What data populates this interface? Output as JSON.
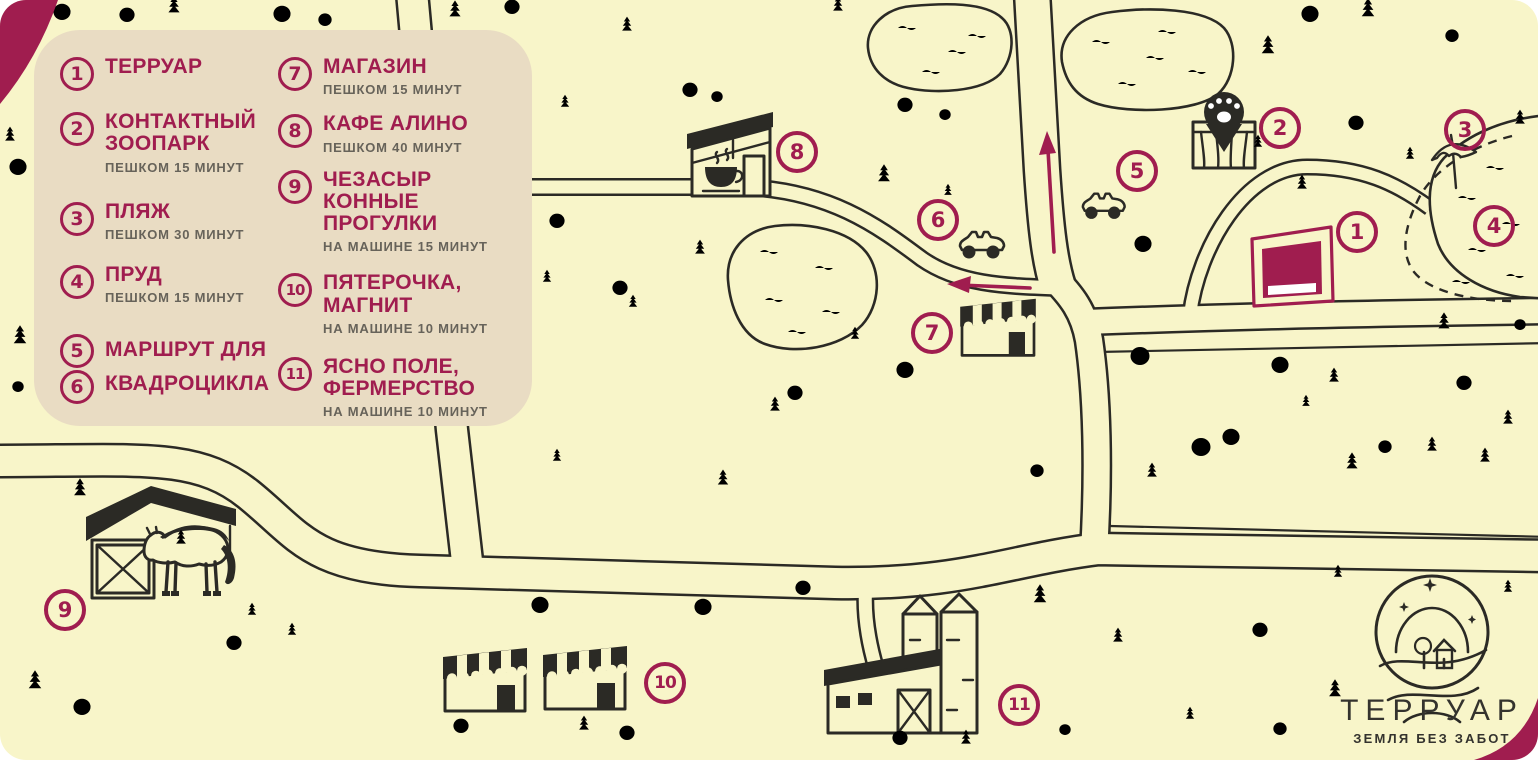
{
  "colors": {
    "background": "#F8F5C9",
    "legend_panel": "#E9DCC3",
    "accent": "#A01D4F",
    "ink": "#2B2A25",
    "note_text": "#67635A"
  },
  "logo": {
    "title": "ТЕРРУАР",
    "subtitle": "ЗЕМЛЯ БЕЗ ЗАБОТ"
  },
  "legend": {
    "columns": [
      [
        {
          "nums": [
            "1"
          ],
          "lines": [
            "ТЕРРУАР"
          ],
          "note": ""
        },
        {
          "nums": [
            "2"
          ],
          "lines": [
            "КОНТАКТНЫЙ",
            "ЗООПАРК"
          ],
          "note": "ПЕШКОМ 15 МИНУТ"
        },
        {
          "nums": [
            "3"
          ],
          "lines": [
            "ПЛЯЖ"
          ],
          "note": "ПЕШКОМ 30 МИНУТ"
        },
        {
          "nums": [
            "4"
          ],
          "lines": [
            "ПРУД"
          ],
          "note": "ПЕШКОМ 15 МИНУТ"
        },
        {
          "nums": [
            "5",
            "6"
          ],
          "lines": [
            "МАРШРУТ ДЛЯ",
            "КВАДРОЦИКЛА"
          ],
          "note": ""
        }
      ],
      [
        {
          "nums": [
            "7"
          ],
          "lines": [
            "МАГАЗИН"
          ],
          "note": "ПЕШКОМ 15 МИНУТ"
        },
        {
          "nums": [
            "8"
          ],
          "lines": [
            "КАФЕ АЛИНО"
          ],
          "note": "ПЕШКОМ 40 МИНУТ"
        },
        {
          "nums": [
            "9"
          ],
          "lines": [
            "ЧЕЗАСЫР",
            "КОННЫЕ ПРОГУЛКИ"
          ],
          "note": "НА МАШИНЕ 15 МИНУТ"
        },
        {
          "nums": [
            "10"
          ],
          "lines": [
            "ПЯТЕРОЧКА,",
            "МАГНИТ"
          ],
          "note": "НА МАШИНЕ 10 МИНУТ"
        },
        {
          "nums": [
            "11"
          ],
          "lines": [
            "ЯСНО ПОЛЕ,",
            "ФЕРМЕРСТВО"
          ],
          "note": "НА МАШИНЕ 10 МИНУТ"
        }
      ]
    ]
  },
  "markers": [
    {
      "label": "1",
      "x": 1357,
      "y": 232
    },
    {
      "label": "2",
      "x": 1280,
      "y": 128
    },
    {
      "label": "3",
      "x": 1465,
      "y": 130
    },
    {
      "label": "4",
      "x": 1494,
      "y": 226
    },
    {
      "label": "5",
      "x": 1137,
      "y": 171
    },
    {
      "label": "6",
      "x": 938,
      "y": 220
    },
    {
      "label": "7",
      "x": 932,
      "y": 333
    },
    {
      "label": "8",
      "x": 797,
      "y": 152
    },
    {
      "label": "9",
      "x": 65,
      "y": 610
    },
    {
      "label": "10",
      "x": 665,
      "y": 683
    },
    {
      "label": "11",
      "x": 1019,
      "y": 705
    }
  ],
  "decorations": [
    [
      "pine",
      174,
      14,
      0.8
    ],
    [
      "pine",
      455,
      18,
      0.8
    ],
    [
      "pine",
      627,
      32,
      0.7
    ],
    [
      "pine",
      838,
      12,
      0.7
    ],
    [
      "pine",
      565,
      108,
      0.6
    ],
    [
      "pine",
      884,
      183,
      0.85
    ],
    [
      "pine",
      948,
      196,
      0.55
    ],
    [
      "pine",
      700,
      255,
      0.7
    ],
    [
      "pine",
      547,
      283,
      0.6
    ],
    [
      "pine",
      633,
      308,
      0.6
    ],
    [
      "pine",
      855,
      340,
      0.6
    ],
    [
      "pine",
      775,
      412,
      0.7
    ],
    [
      "pine",
      723,
      486,
      0.75
    ],
    [
      "pine",
      557,
      462,
      0.6
    ],
    [
      "pine",
      1268,
      55,
      0.9
    ],
    [
      "pine",
      1368,
      18,
      0.9
    ],
    [
      "pine",
      1410,
      160,
      0.6
    ],
    [
      "pine",
      1520,
      125,
      0.7
    ],
    [
      "pine",
      1258,
      148,
      0.6
    ],
    [
      "pine",
      1302,
      190,
      0.7
    ],
    [
      "pine",
      1444,
      330,
      0.8
    ],
    [
      "pine",
      1508,
      425,
      0.7
    ],
    [
      "pine",
      1432,
      452,
      0.7
    ],
    [
      "pine",
      1334,
      383,
      0.7
    ],
    [
      "pine",
      1306,
      407,
      0.55
    ],
    [
      "pine",
      1352,
      470,
      0.8
    ],
    [
      "pine",
      1152,
      478,
      0.7
    ],
    [
      "pine",
      1485,
      463,
      0.7
    ],
    [
      "pine",
      10,
      142,
      0.7
    ],
    [
      "pine",
      20,
      345,
      0.9
    ],
    [
      "pine",
      80,
      497,
      0.85
    ],
    [
      "pine",
      181,
      545,
      0.7
    ],
    [
      "pine",
      252,
      616,
      0.6
    ],
    [
      "pine",
      35,
      690,
      0.9
    ],
    [
      "pine",
      292,
      636,
      0.6
    ],
    [
      "pine",
      584,
      731,
      0.7
    ],
    [
      "pine",
      966,
      745,
      0.7
    ],
    [
      "pine",
      1040,
      604,
      0.9
    ],
    [
      "pine",
      1118,
      643,
      0.7
    ],
    [
      "pine",
      1338,
      578,
      0.6
    ],
    [
      "pine",
      1335,
      698,
      0.85
    ],
    [
      "pine",
      1508,
      593,
      0.6
    ],
    [
      "pine",
      1190,
      720,
      0.6
    ],
    [
      "tree",
      62,
      20,
      0.9
    ],
    [
      "tree",
      127,
      22,
      0.8
    ],
    [
      "tree",
      282,
      22,
      0.9
    ],
    [
      "tree",
      325,
      26,
      0.7
    ],
    [
      "tree",
      512,
      14,
      0.8
    ],
    [
      "tree",
      690,
      97,
      0.8
    ],
    [
      "tree",
      717,
      102,
      0.6
    ],
    [
      "tree",
      905,
      112,
      0.8
    ],
    [
      "tree",
      945,
      120,
      0.6
    ],
    [
      "tree",
      1310,
      22,
      0.9
    ],
    [
      "tree",
      1356,
      130,
      0.8
    ],
    [
      "tree",
      1452,
      42,
      0.7
    ],
    [
      "tree",
      18,
      175,
      0.9
    ],
    [
      "tree",
      18,
      392,
      0.6
    ],
    [
      "tree",
      557,
      228,
      0.8
    ],
    [
      "tree",
      620,
      295,
      0.8
    ],
    [
      "tree",
      795,
      400,
      0.8
    ],
    [
      "tree",
      905,
      378,
      0.9
    ],
    [
      "tree",
      1143,
      252,
      0.9
    ],
    [
      "tree",
      1140,
      365,
      1
    ],
    [
      "tree",
      1280,
      373,
      0.9
    ],
    [
      "tree",
      1231,
      445,
      0.9
    ],
    [
      "tree",
      1201,
      456,
      1
    ],
    [
      "tree",
      1464,
      390,
      0.8
    ],
    [
      "tree",
      1520,
      330,
      0.6
    ],
    [
      "tree",
      1385,
      453,
      0.7
    ],
    [
      "tree",
      1037,
      477,
      0.7
    ],
    [
      "tree",
      82,
      715,
      0.9
    ],
    [
      "tree",
      234,
      650,
      0.8
    ],
    [
      "tree",
      540,
      613,
      0.9
    ],
    [
      "tree",
      703,
      615,
      0.9
    ],
    [
      "tree",
      461,
      733,
      0.8
    ],
    [
      "tree",
      627,
      740,
      0.8
    ],
    [
      "tree",
      803,
      595,
      0.8
    ],
    [
      "tree",
      1260,
      637,
      0.8
    ],
    [
      "tree",
      900,
      745,
      0.8
    ],
    [
      "tree",
      1065,
      735,
      0.6
    ],
    [
      "tree",
      1280,
      735,
      0.7
    ],
    [
      "grass",
      95,
      127,
      1
    ],
    [
      "grass",
      445,
      102,
      1
    ],
    [
      "grass",
      615,
      152,
      1
    ],
    [
      "grass",
      688,
      162,
      1
    ],
    [
      "grass",
      778,
      62,
      1
    ],
    [
      "grass",
      1345,
      68,
      1
    ],
    [
      "grass",
      1480,
      92,
      1
    ],
    [
      "grass",
      648,
      432,
      1
    ],
    [
      "grass",
      712,
      532,
      1
    ],
    [
      "grass",
      205,
      662,
      1
    ],
    [
      "grass",
      302,
      742,
      1
    ],
    [
      "grass",
      648,
      610,
      1
    ],
    [
      "grass",
      952,
      600,
      1
    ],
    [
      "grass",
      1178,
      536,
      1
    ],
    [
      "grass",
      1322,
      435,
      1
    ],
    [
      "grass",
      1448,
      560,
      1
    ],
    [
      "grass",
      1108,
      740,
      1
    ],
    [
      "grass",
      390,
      585,
      1
    ],
    [
      "grass",
      998,
      420,
      1
    ],
    [
      "grass",
      872,
      445,
      1
    ],
    [
      "grass",
      60,
      440,
      1
    ],
    [
      "grass",
      150,
      625,
      1
    ],
    [
      "grass",
      1238,
      300,
      1
    ],
    [
      "wave",
      898,
      28,
      1
    ],
    [
      "wave",
      948,
      52,
      1
    ],
    [
      "wave",
      922,
      72,
      1
    ],
    [
      "wave",
      968,
      36,
      1
    ],
    [
      "wave",
      1092,
      42,
      1
    ],
    [
      "wave",
      1158,
      32,
      1
    ],
    [
      "wave",
      1188,
      72,
      1
    ],
    [
      "wave",
      1118,
      84,
      1
    ],
    [
      "wave",
      1146,
      58,
      1
    ],
    [
      "wave",
      760,
      252,
      1
    ],
    [
      "wave",
      815,
      268,
      1
    ],
    [
      "wave",
      765,
      300,
      1
    ],
    [
      "wave",
      822,
      312,
      1
    ],
    [
      "wave",
      788,
      332,
      1
    ],
    [
      "wave",
      1486,
      168,
      1
    ],
    [
      "wave",
      1458,
      198,
      1
    ],
    [
      "wave",
      1502,
      224,
      1
    ],
    [
      "wave",
      1468,
      250,
      1
    ],
    [
      "wave",
      1506,
      276,
      1
    ],
    [
      "wave",
      1452,
      282,
      1
    ]
  ]
}
